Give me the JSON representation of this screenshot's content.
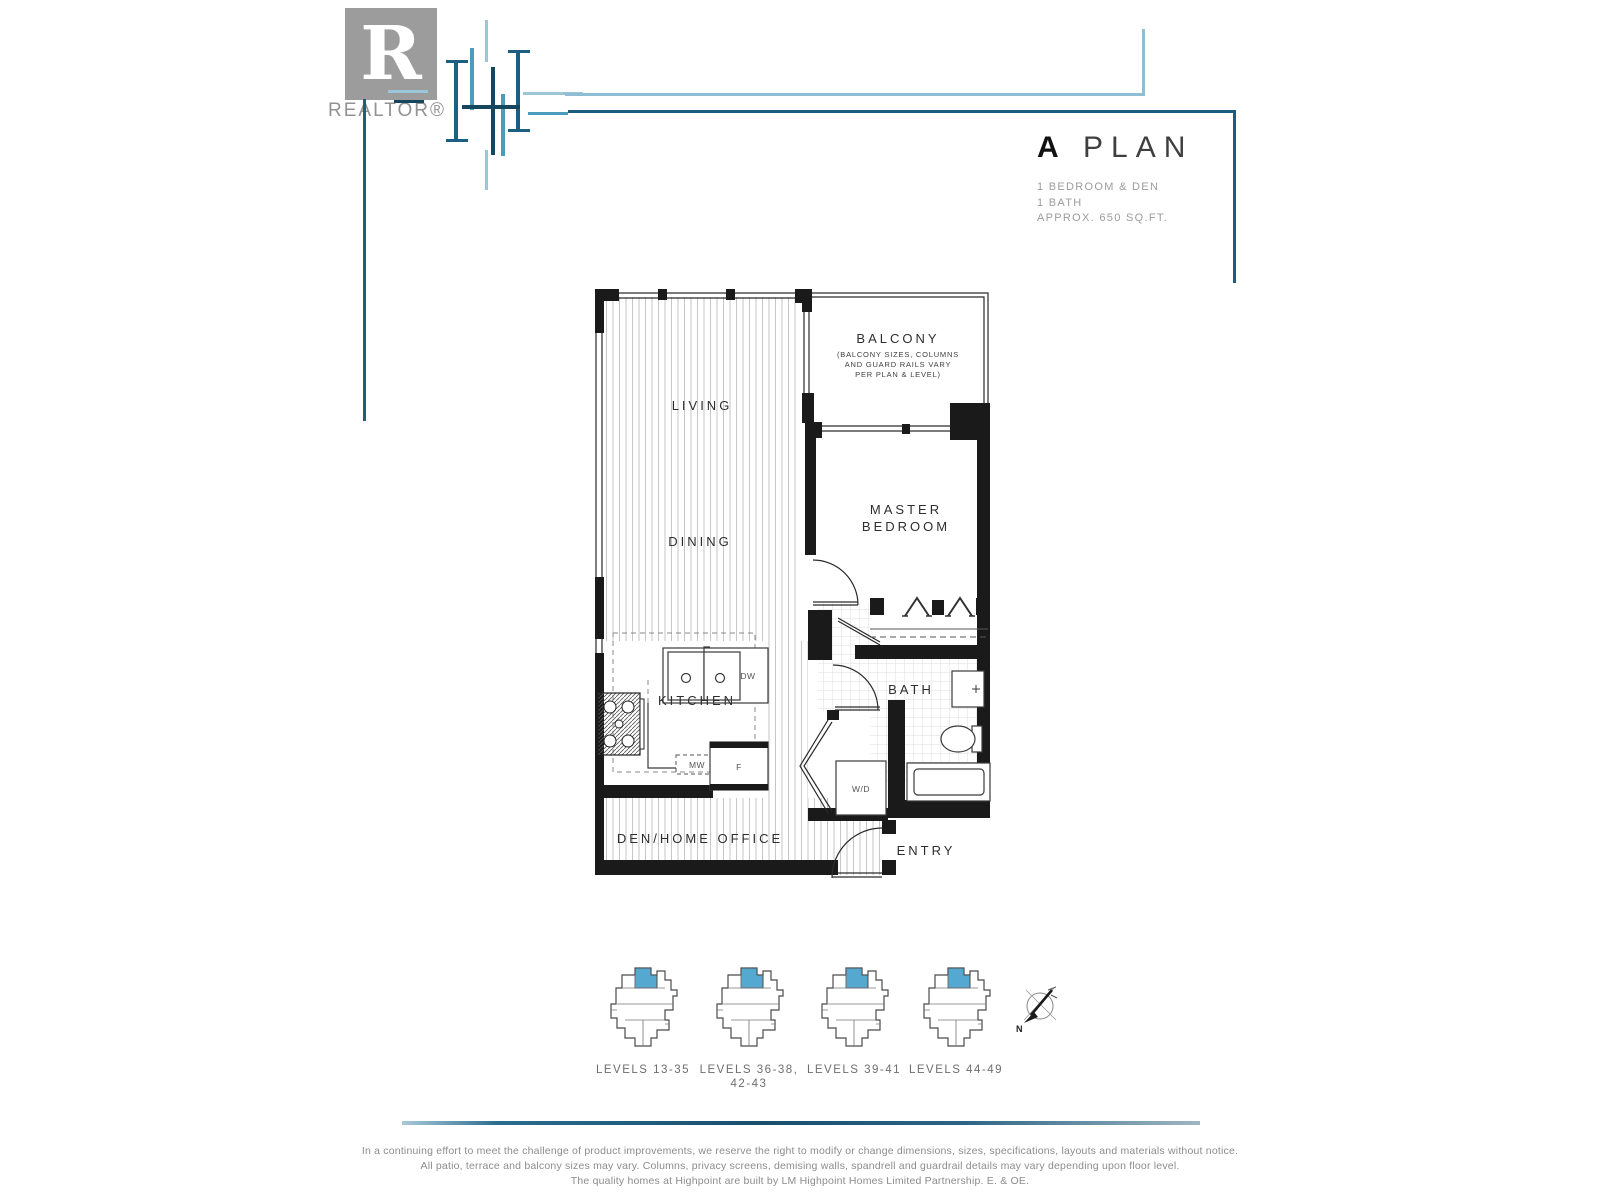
{
  "header": {
    "realtor_logo_letter": "R",
    "realtor_label": "REALTOR®",
    "plan_letter": "A",
    "plan_word": "PLAN",
    "details": [
      "1 BEDROOM & DEN",
      "1 BATH",
      "APPROX. 650 SQ.FT."
    ]
  },
  "plan": {
    "living": "LIVING",
    "dining": "DINING",
    "balcony_title": "BALCONY",
    "balcony_note1": "(BALCONY SIZES, COLUMNS",
    "balcony_note2": "AND GUARD RAILS VARY",
    "balcony_note3": "PER PLAN & LEVEL)",
    "master1": "MASTER",
    "master2": "BEDROOM",
    "kitchen": "KITCHEN",
    "bath": "BATH",
    "den": "DEN/HOME OFFICE",
    "entry": "ENTRY",
    "wd": "W/D",
    "dw": "DW",
    "mw": "MW",
    "fridge": "F"
  },
  "keyplates": {
    "items": [
      {
        "label": "LEVELS 13-35",
        "label2": ""
      },
      {
        "label": "LEVELS 36-38,",
        "label2": "42-43"
      },
      {
        "label": "LEVELS 39-41",
        "label2": ""
      },
      {
        "label": "LEVELS 44-49",
        "label2": ""
      }
    ],
    "compass_n": "N",
    "highlight_color": "#55a8cf"
  },
  "colors": {
    "light_blue_line": "#8fbdd3",
    "dark_blue_line": "#1d5c7e",
    "teal_line": "#1f6075",
    "wall": "#1a1a1a",
    "keyplate_highlight": "#55a8cf"
  },
  "footer": {
    "lines": [
      "In a continuing effort to meet the challenge of product improvements, we reserve the right to modify or change dimensions, sizes, specifications, layouts and materials without notice.",
      "All patio, terrace and balcony sizes may vary. Columns, privacy screens, demising walls, spandrell and guardrail details may vary depending upon floor level.",
      "The quality homes at Highpoint are built by LM Highpoint Homes Limited Partnership. E. & OE."
    ]
  }
}
